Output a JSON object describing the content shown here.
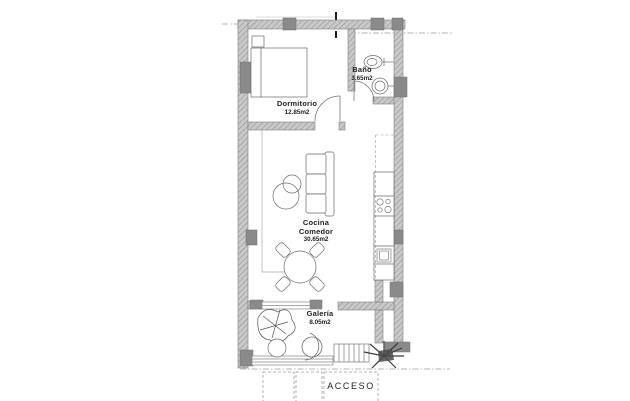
{
  "floorplan": {
    "rooms": [
      {
        "id": "dormitorio",
        "label": "Dormitorio",
        "area": "12.85m2"
      },
      {
        "id": "bano",
        "label": "Baño",
        "area": "3.65m2"
      },
      {
        "id": "cocina-comedor",
        "label": "Cocina",
        "label2": "Comedor",
        "area": "30.65m2"
      },
      {
        "id": "galeria",
        "label": "Galería",
        "area": "8.05m2"
      }
    ],
    "entrance": {
      "label": "ACCESO"
    },
    "colors": {
      "background": "#ffffff",
      "wall_fill": "#c9c9c9",
      "wall_hatch": "#909090",
      "column_fill": "#8a8a8a",
      "furniture_line": "#666666",
      "dash_line": "#9b9b9b",
      "text": "#222222"
    }
  }
}
